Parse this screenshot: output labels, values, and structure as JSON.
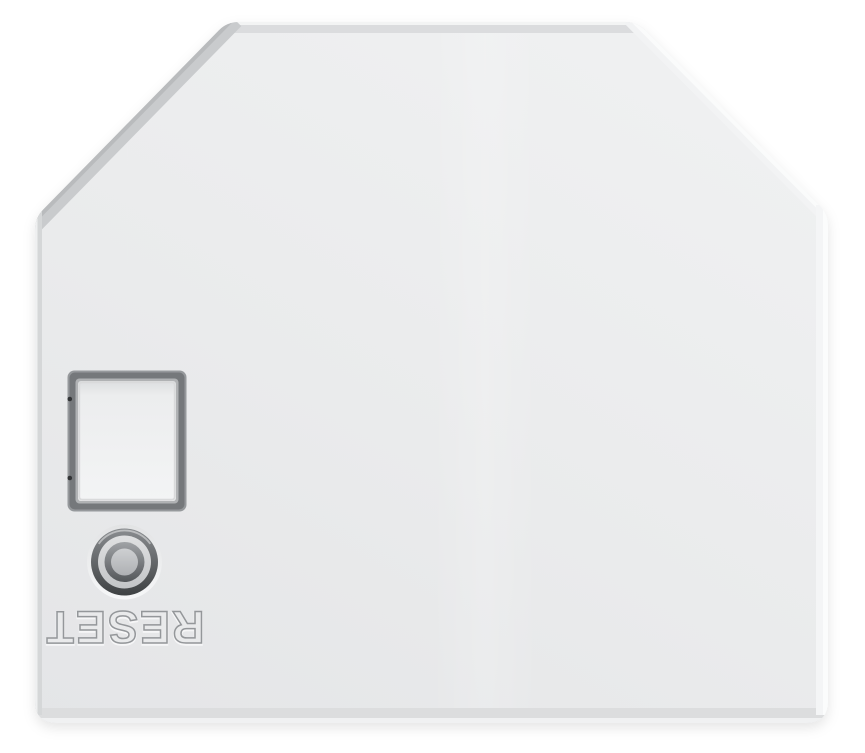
{
  "photo": {
    "subject": "white-electronic-module-top-view"
  },
  "reset_button": {
    "label": "RESET"
  },
  "colors": {
    "background": "#ffffff",
    "body_face": "#eaebec",
    "body_face_light": "#f0f1f2",
    "body_face_dark": "#e4e5e7",
    "chamfer_shadow_edge": "#b9bbbd",
    "top_shadow_band": "#dbdcde",
    "right_highlight_edge": "#fafbfb",
    "bottom_shadow_band": "#dcddde",
    "window_outer_line": "#96999c",
    "window_frame_dark": "#75787b",
    "window_bevel": "#b0b2b4",
    "window_panel": "#f1f2f3",
    "window_pin_dot": "#323436",
    "button_rim": "#eff0f1",
    "button_bezel_top": "#8a8d90",
    "button_bezel_bottom": "#3e4143",
    "button_flat_ring": "#d2d4d5",
    "button_inner_ring_top": "#a0a3a6",
    "button_inner_ring_bottom": "#54575a",
    "button_center": "#c0c2c4",
    "label_engraving": "#94979a",
    "label_fill": "#e9eaeb"
  }
}
